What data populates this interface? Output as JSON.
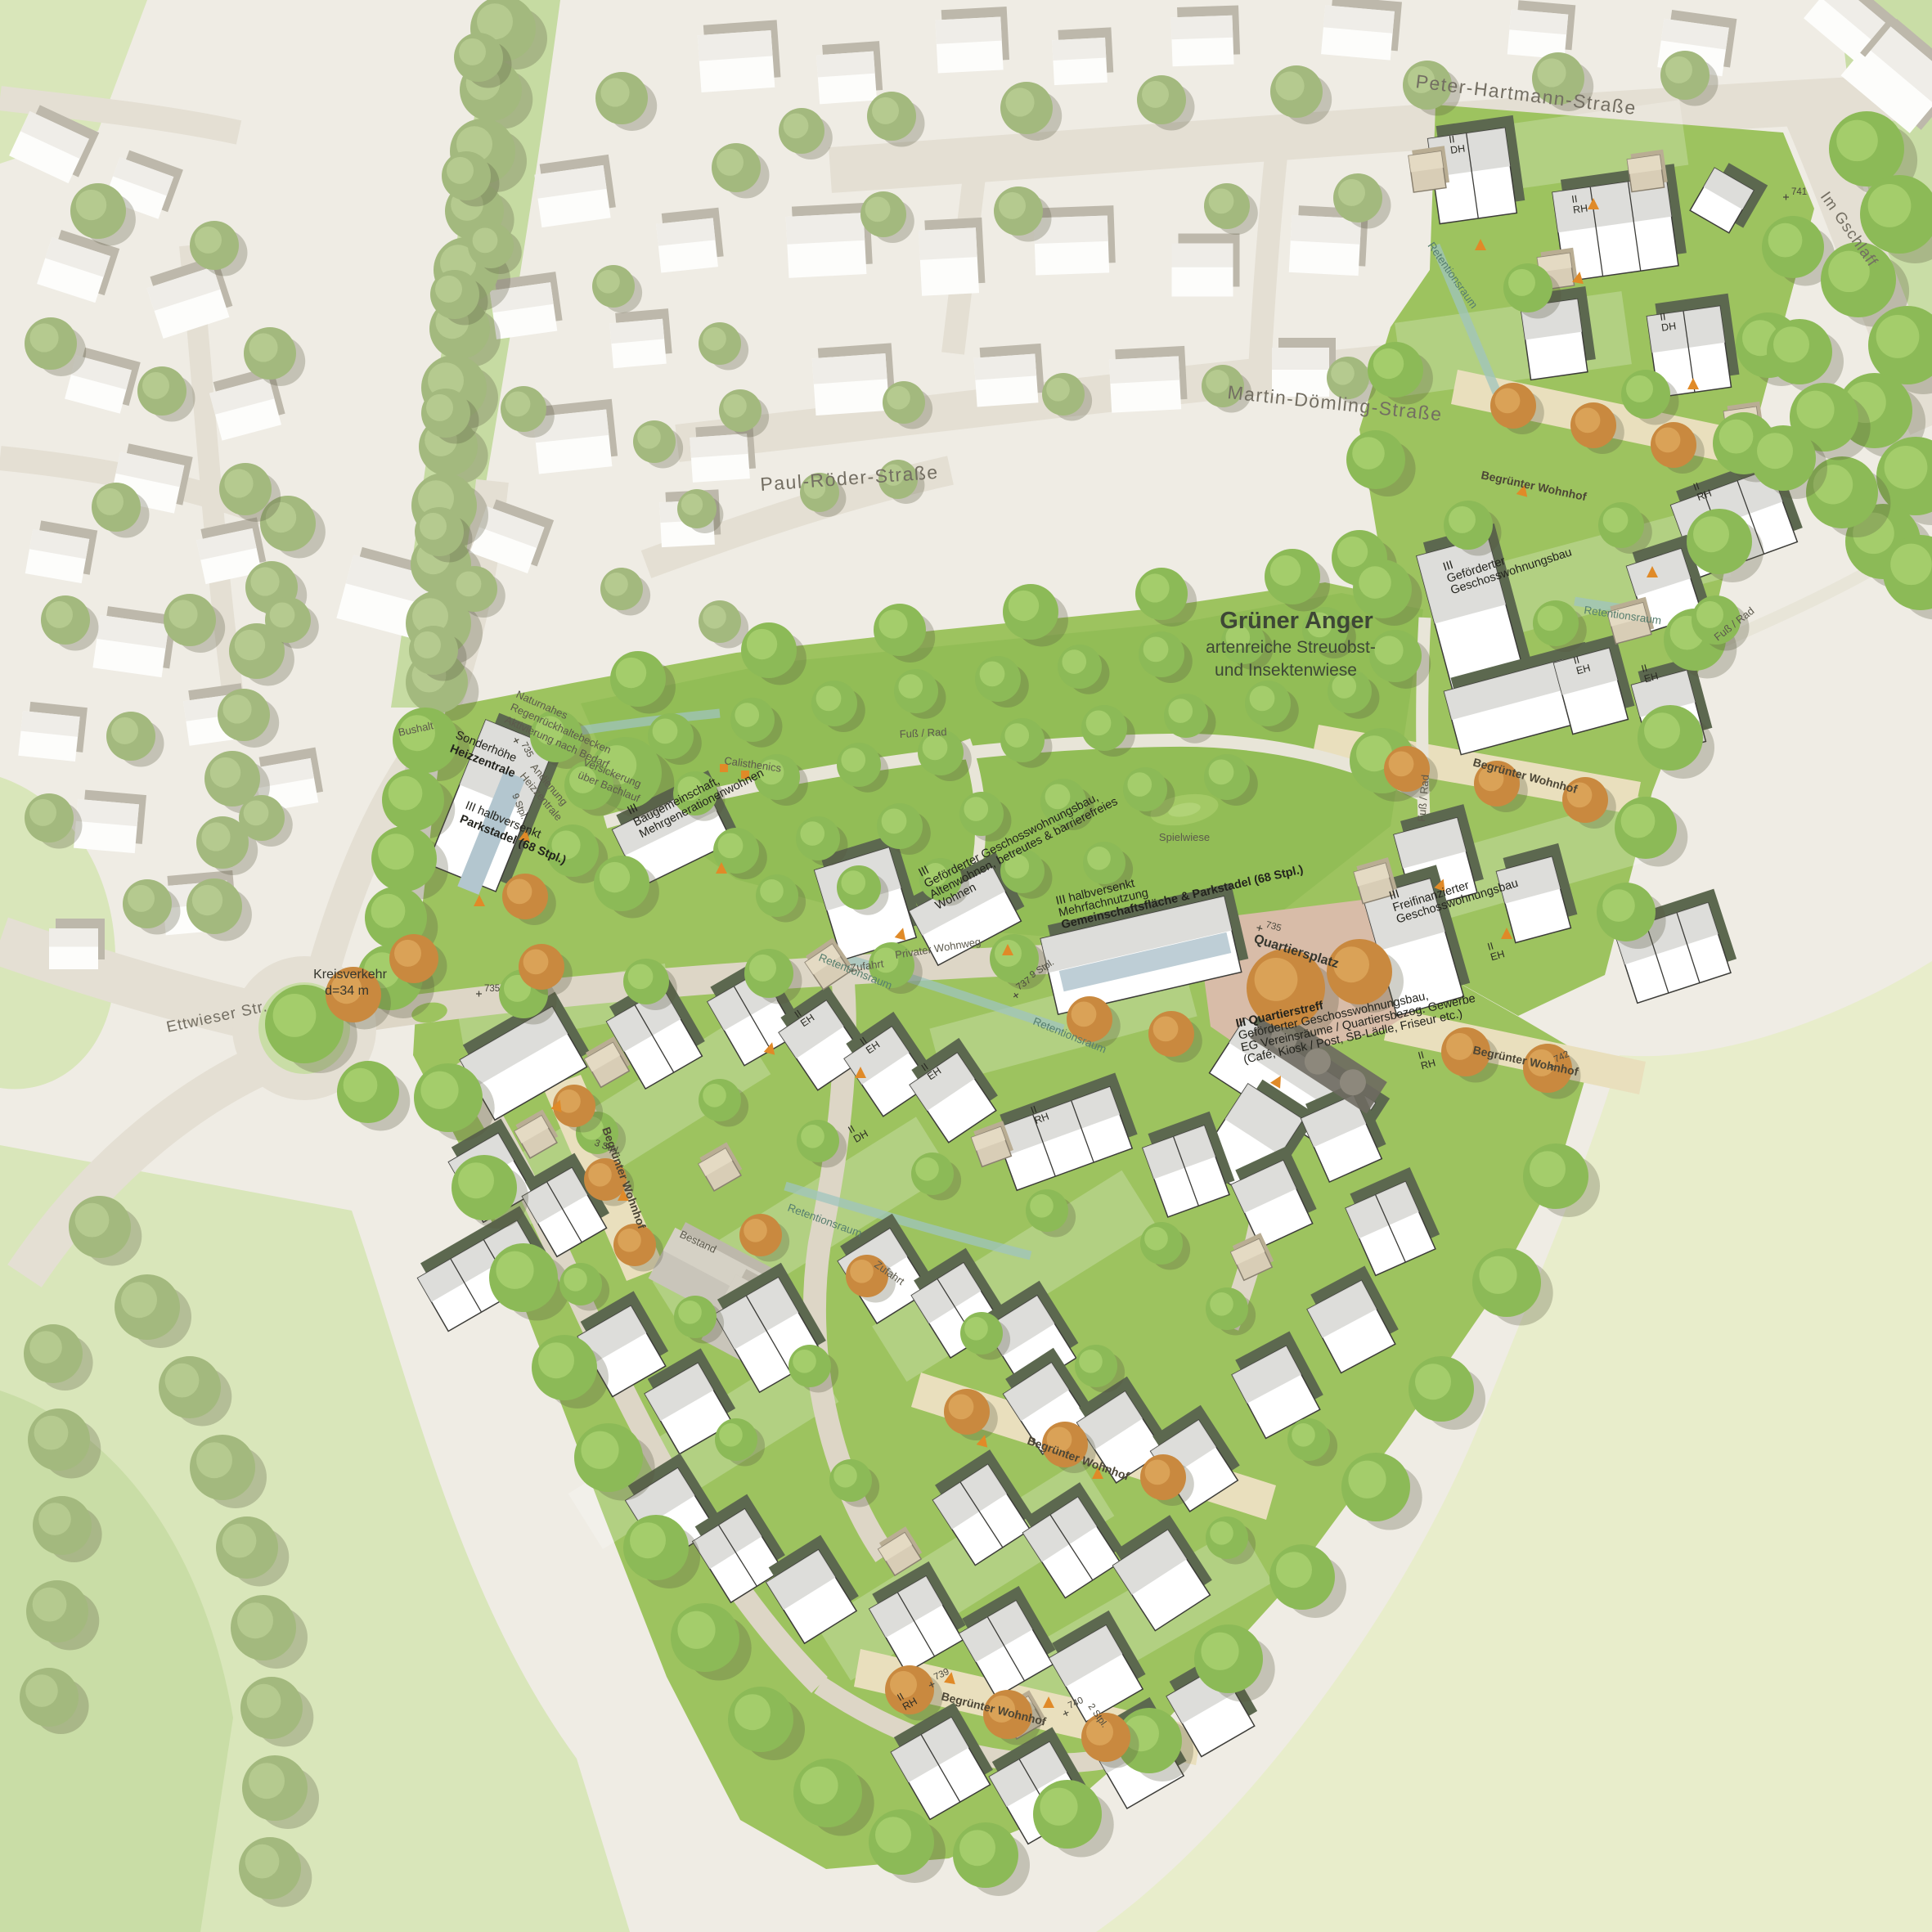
{
  "colors": {
    "context_bg": "#efece4",
    "context_road": "#e4dfd3",
    "context_building_side": "#bdb8ab",
    "context_building_roof": "#edebe5",
    "field_pale": "#e8edcb",
    "field_green": "#d9e6ba",
    "field_dark": "#c9dda6",
    "corridor_green": "#c6dba2",
    "quarter_green": "#9dc35f",
    "park_green": "#92bd56",
    "lane_sand": "#e9dfbd",
    "plaza_rose": "#d8bca8",
    "street_grey": "#ddd6c6",
    "path_light": "#e8e5d8",
    "tree_context": "#a3b97e",
    "tree_context_hi": "#b9cc92",
    "tree_green": "#8cba57",
    "tree_green_hi": "#a8d06e",
    "tree_autumn": "#c9893f",
    "tree_autumn_hi": "#dda75c",
    "tree_shadow": "rgba(85,85,60,0.28)",
    "new_building_side": "#5c684f",
    "new_building_roof": "#d9d9d6",
    "new_building_stroke": "#3c3c38",
    "shed_tan": "#d8cdb6",
    "water": "#9fc4bd",
    "pv_roof": "#b3c6cf",
    "marker_orange": "#e08a28",
    "bestand_grey": "#c9c5ba"
  },
  "streets": {
    "peter_hartmann": "Peter-Hartmann-Straße",
    "martin_doemling": "Martin-Dömling-Straße",
    "paul_roeder": "Paul-Röder-Straße",
    "ettwieser": "Ettwieser Str.",
    "im_gschlaff": "Im Gschlaff"
  },
  "park": {
    "title": "Grüner Anger",
    "subtitle1": "artenreiche Streuobst-",
    "subtitle2": "und Insektenwiese",
    "calisthenics": "Calisthenics",
    "spielwiese": "Spielwiese"
  },
  "places": {
    "quartiersplatz": "Quartiersplatz",
    "kreisverkehr1": "Kreisverkehr",
    "kreisverkehr2": "d=34 m",
    "bushalt": "Bushalt",
    "fuss_rad": "Fuß / Rad",
    "privater_wohnweg": "Privater Wohnweg",
    "begruenter_wohnhof": "Begrünter Wohnhof",
    "retentionsraum": "Retentionsraum",
    "zufahrt": "Zufahrt",
    "bestand": "Bestand"
  },
  "notes": {
    "regen1": "Naturnahes",
    "regen2": "Regenrückhaltebecken",
    "regen3": "Aktivierung nach Bedarf",
    "andienung1": "Andienung",
    "andienung2": "Heizzentrale",
    "versickerung1": "Versickerung",
    "versickerung2": "über Bachlauf"
  },
  "buildings": {
    "heiz1": "Sonderhöhe",
    "heiz2": "Heizzentrale",
    "park1": "III halbversenkt",
    "park2": "Parkstadel (68 Stpl.)",
    "bau1": "III",
    "bau2": "Baugemeinschaft,",
    "bau3": "Mehrgenerationenwohnen",
    "alten1": "III",
    "alten2": "Geförderter Geschosswohnungsbau,",
    "alten3": "Altenwohnen, betreutes & barrierefreies",
    "alten4": "Wohnen",
    "gem1": "III halbversenkt",
    "gem2": "Mehrfachnutzung",
    "gem3": "Gemeinschaftsfläche & Parkstadel (68 Stpl.)",
    "frei1": "III",
    "frei2": "Freifinanzierter",
    "frei3": "Geschosswohnungsbau",
    "treff1": "III Quartierstreff",
    "treff2": "Geförderter Geschosswohnungsbau,",
    "treff3": "EG Vereinsräume / Quartiersbezog. Gewerbe",
    "treff4": "(Café, Kiosk / Post, SB-Lädle, Friseur etc.)",
    "gef1": "III",
    "gef2": "Geförderter",
    "gef3": "Geschosswohnungsbau"
  },
  "units": {
    "ii": "II",
    "dh": "DH",
    "rh": "RH",
    "eh": "EH"
  },
  "markers": {
    "m735": "735",
    "m737": "737",
    "m739": "739",
    "m740": "740",
    "m741": "741",
    "m742": "742",
    "stpl2": "2 Stpl.",
    "stpl3": "3 Stpl.",
    "stpl9": "9 Stpl."
  }
}
